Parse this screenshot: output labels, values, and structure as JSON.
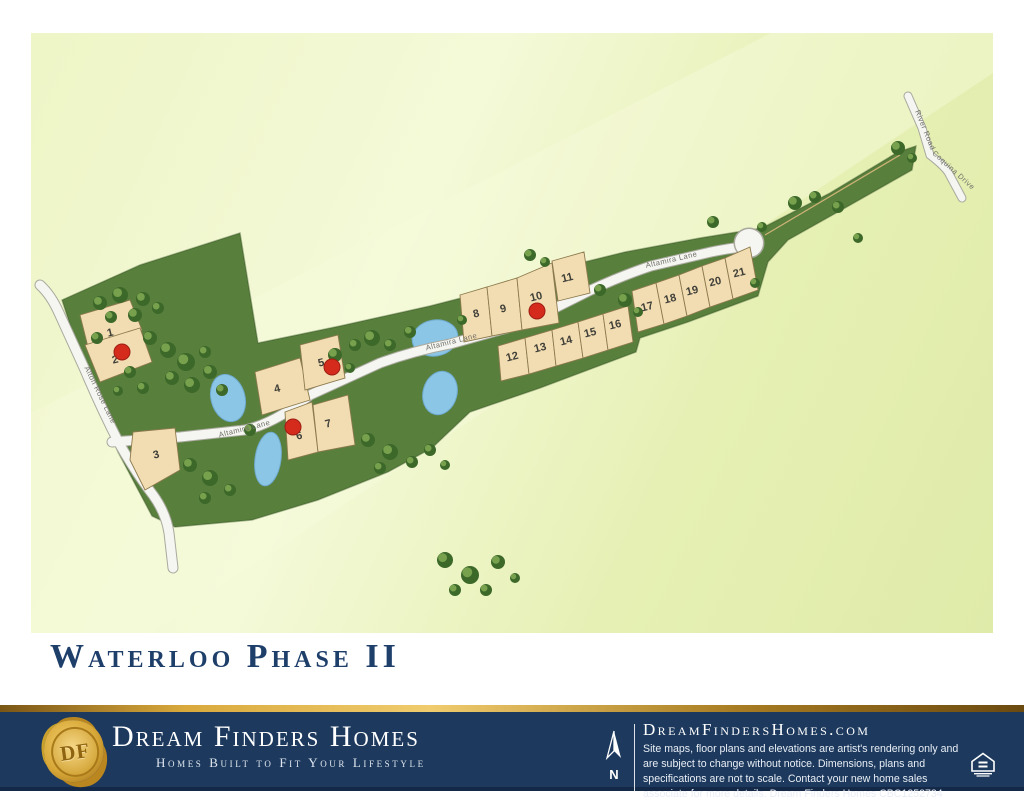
{
  "title": "Waterloo Phase II",
  "map": {
    "roads": {
      "altamira": "Altamira Lane",
      "west": "Alton Rose Lane",
      "river": "River Road",
      "coquina": "Coquina Drive"
    },
    "lots": [
      {
        "number": "1",
        "sold": false
      },
      {
        "number": "2",
        "sold": true
      },
      {
        "number": "3",
        "sold": false
      },
      {
        "number": "4",
        "sold": false
      },
      {
        "number": "5",
        "sold": true
      },
      {
        "number": "6",
        "sold": true
      },
      {
        "number": "7",
        "sold": false
      },
      {
        "number": "8",
        "sold": false
      },
      {
        "number": "9",
        "sold": false
      },
      {
        "number": "10",
        "sold": true
      },
      {
        "number": "11",
        "sold": false
      },
      {
        "number": "12",
        "sold": false
      },
      {
        "number": "13",
        "sold": false
      },
      {
        "number": "14",
        "sold": false
      },
      {
        "number": "15",
        "sold": false
      },
      {
        "number": "16",
        "sold": false
      },
      {
        "number": "17",
        "sold": false
      },
      {
        "number": "18",
        "sold": false
      },
      {
        "number": "19",
        "sold": false
      },
      {
        "number": "20",
        "sold": false
      },
      {
        "number": "21",
        "sold": false
      }
    ],
    "sold_color": "#d42b1d"
  },
  "footer": {
    "monogram": "DF",
    "brand": "Dream Finders Homes",
    "tagline": "Homes Built to Fit Your Lifestyle",
    "north_label": "N",
    "website": "DreamFindersHomes.com",
    "disclaimer": "Site maps, floor plans and elevations are artist's rendering only and are subject to change without notice. Dimensions, plans and specifications are not to scale. Contact your new home sales associate for more details. Dream Finders Homes CBC1252734",
    "colors": {
      "navy": "#1d3a5e",
      "gold": "#d9a93c"
    }
  }
}
